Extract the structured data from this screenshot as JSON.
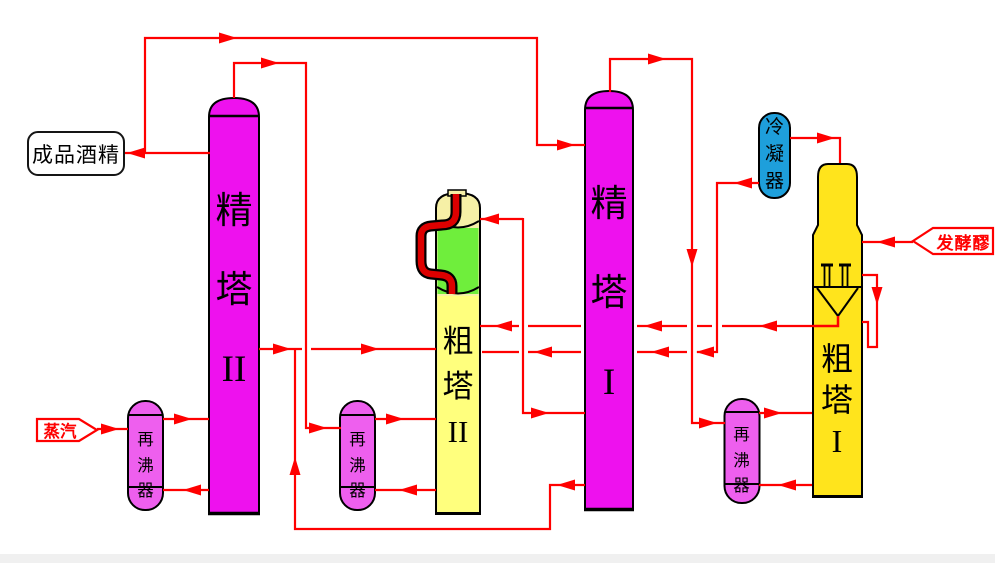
{
  "labels": {
    "product_box": "成品酒精",
    "steam": "蒸汽",
    "mash": "发酵醪",
    "column_jing2": [
      "精",
      "塔",
      "II"
    ],
    "column_cu2": [
      "粗",
      "塔",
      "II"
    ],
    "column_jing1": [
      "精",
      "塔",
      "I"
    ],
    "column_cu1": [
      "粗",
      "塔",
      "I"
    ],
    "condenser": [
      "冷",
      "凝",
      "器"
    ],
    "reboiler_left": [
      "再",
      "沸",
      "器"
    ],
    "reboiler_middle": [
      "再",
      "沸",
      "器"
    ],
    "reboiler_right": [
      "再",
      "沸",
      "器"
    ]
  },
  "colors": {
    "magenta": "#EE11EE",
    "reboiler_pink": "#EE5FEE",
    "pale_yellow": "#FFFF7D",
    "top_khaki": "#F6F0A6",
    "green": "#6FEE3C",
    "gold": "#FFE41C",
    "blue": "#1E9FDB",
    "red": "#FF0000",
    "pipe_red": "#DD0000",
    "ink": "#000000"
  }
}
